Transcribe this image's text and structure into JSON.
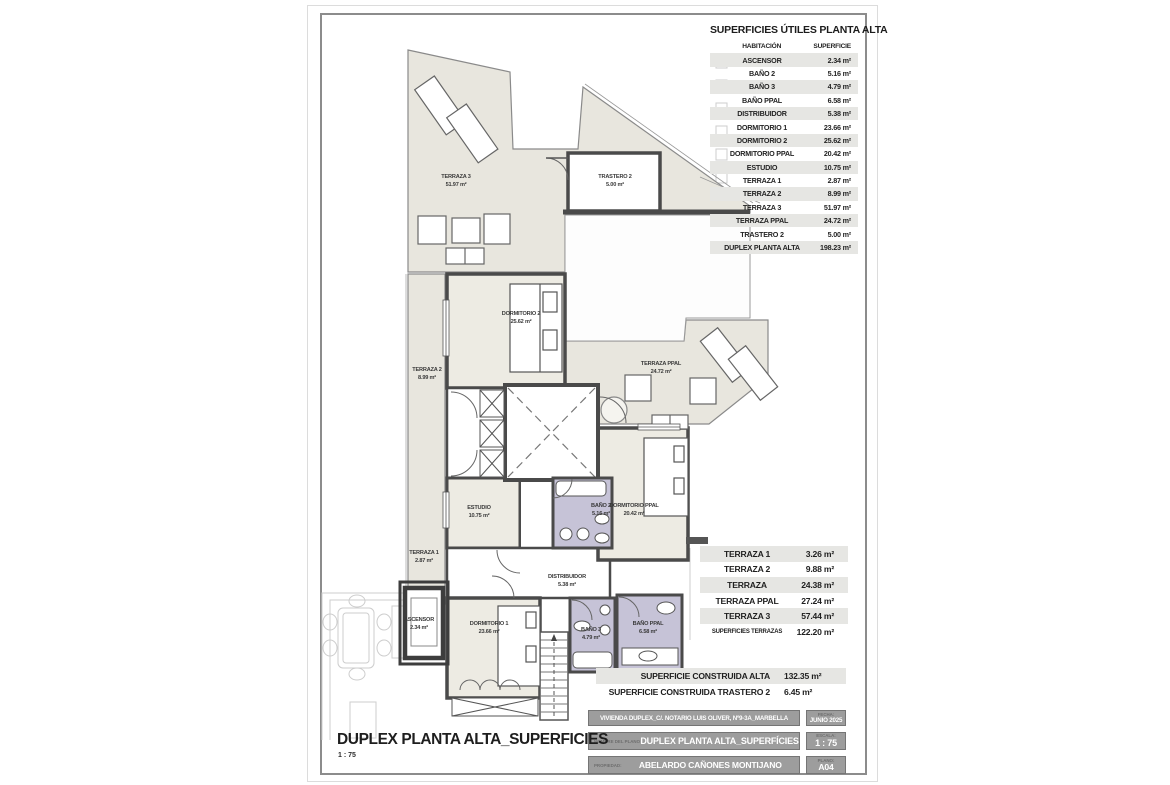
{
  "palette": {
    "wall": "#4a4a4a",
    "terrace_fill": "#e8e6de",
    "room_fill": "#edebe3",
    "bath_fill": "#c6c3d7",
    "row_shade": "#e6e6e3",
    "titleblock_gray": "#9d9d9d",
    "frame_gray": "#8c8c8c"
  },
  "tables": {
    "superficies_utiles": {
      "title": "SUPERFICIES ÚTILES PLANTA ALTA",
      "col_headers": {
        "room": "HABITACIÓN",
        "area": "SUPERFICIE"
      },
      "rows": [
        {
          "label": "ASCENSOR",
          "value": "2.34 m²"
        },
        {
          "label": "BAÑO 2",
          "value": "5.16 m²"
        },
        {
          "label": "BAÑO 3",
          "value": "4.79 m²"
        },
        {
          "label": "BAÑO PPAL",
          "value": "6.58 m²"
        },
        {
          "label": "DISTRIBUIDOR",
          "value": "5.38 m²"
        },
        {
          "label": "DORMITORIO 1",
          "value": "23.66 m²"
        },
        {
          "label": "DORMITORIO 2",
          "value": "25.62 m²"
        },
        {
          "label": "DORMITORIO PPAL",
          "value": "20.42 m²"
        },
        {
          "label": "ESTUDIO",
          "value": "10.75 m²"
        },
        {
          "label": "TERRAZA 1",
          "value": "2.87 m²"
        },
        {
          "label": "TERRAZA 2",
          "value": "8.99 m²"
        },
        {
          "label": "TERRAZA 3",
          "value": "51.97 m²"
        },
        {
          "label": "TERRAZA PPAL",
          "value": "24.72 m²"
        },
        {
          "label": "TRASTERO 2",
          "value": "5.00 m²"
        },
        {
          "label": "DUPLEX PLANTA ALTA",
          "value": "198.23 m²"
        }
      ]
    },
    "terrazas": {
      "rows": [
        {
          "label": "TERRAZA 1",
          "value": "3.26 m²"
        },
        {
          "label": "TERRAZA 2",
          "value": "9.88 m²"
        },
        {
          "label": "TERRAZA",
          "value": "24.38 m²"
        },
        {
          "label": "TERRAZA PPAL",
          "value": "27.24 m²"
        },
        {
          "label": "TERRAZA 3",
          "value": "57.44 m²"
        },
        {
          "label": "SUPERFICIES TERRAZAS",
          "value": "122.20 m²"
        }
      ]
    },
    "construida": {
      "rows": [
        {
          "label": "SUPERFICIE CONSTRUIDA ALTA",
          "value": "132.35 m²"
        },
        {
          "label": "SUPERFICIE CONSTRUIDA TRASTERO 2",
          "value": "6.45 m²"
        }
      ]
    }
  },
  "title_block": {
    "row1": {
      "value": "VIVIENDA DUPLEX_C/. NOTARIO LUIS OLIVER, Nº9-3A_MARBELLA",
      "side_label": "FECHA:",
      "side_value": "JUNIO 2025"
    },
    "row2": {
      "label": "NOMBRE DEL PLANO",
      "value": "DUPLEX PLANTA ALTA_SUPERFÍCIES",
      "side_label": "ESCALA:",
      "side_value": "1 : 75"
    },
    "row3": {
      "label": "PROPIEDAD:",
      "value": "ABELARDO CAÑONES MONTIJANO",
      "side_label": "PLANO:",
      "side_value": "A04"
    }
  },
  "footer": {
    "title": "DUPLEX PLANTA ALTA_SUPERFICIES",
    "scale": "1 : 75"
  },
  "plan": {
    "rooms": {
      "terraza3": {
        "name": "TERRAZA 3",
        "area": "51.97 m²"
      },
      "trastero2": {
        "name": "TRASTERO 2",
        "area": "5.00 m²"
      },
      "dormitorio2": {
        "name": "DORMITORIO 2",
        "area": "25.62 m²"
      },
      "terraza2": {
        "name": "TERRAZA 2",
        "area": "8.99 m²"
      },
      "terraza_ppal": {
        "name": "TERRAZA PPAL",
        "area": "24.72 m²"
      },
      "estudio": {
        "name": "ESTUDIO",
        "area": "10.75 m²"
      },
      "bano2": {
        "name": "BAÑO 2",
        "area": "5.16 m²"
      },
      "dormitorio_ppal": {
        "name": "DORMITORIO PPAL",
        "area": "20.42 m²"
      },
      "terraza1": {
        "name": "TERRAZA 1",
        "area": "2.87 m²"
      },
      "distribuidor": {
        "name": "DISTRIBUIDOR",
        "area": "5.38 m²"
      },
      "ascensor": {
        "name": "ASCENSOR",
        "area": "2.34 m²"
      },
      "dormitorio1": {
        "name": "DORMITORIO 1",
        "area": "23.66 m²"
      },
      "bano3": {
        "name": "BAÑO 3",
        "area": "4.79 m²"
      },
      "bano_ppal": {
        "name": "BAÑO PPAL",
        "area": "6.58 m²"
      }
    }
  }
}
